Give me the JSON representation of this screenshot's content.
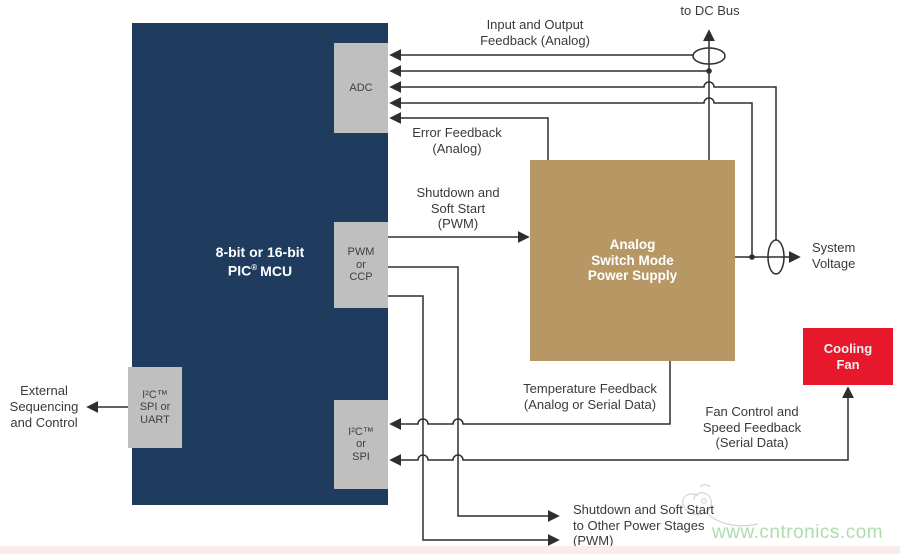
{
  "blocks": {
    "mcu": {
      "line1": "8-bit or 16-bit",
      "line2_pre": "PIC",
      "line2_sup": "®",
      "line2_post": "MCU"
    },
    "adc": {
      "label": "ADC"
    },
    "pwm": {
      "line1": "PWM",
      "line2": "or",
      "line3": "CCP"
    },
    "i2c_spi": {
      "line1": "I²C™",
      "line2": "or",
      "line3": "SPI"
    },
    "i2c_spi_uart": {
      "line1": "I²C™",
      "line2": "SPI or",
      "line3": "UART"
    },
    "psu": {
      "line1": "Analog",
      "line2": "Switch Mode",
      "line3": "Power Supply"
    },
    "fan": {
      "line1": "Cooling",
      "line2": "Fan"
    }
  },
  "labels": {
    "to_dc_bus": "to DC Bus",
    "input_output": {
      "line1": "Input and Output",
      "line2": "Feedback (Analog)"
    },
    "error_feedback": {
      "line1": "Error Feedback",
      "line2": "(Analog)"
    },
    "shutdown_soft_start": {
      "line1": "Shutdown and",
      "line2": "Soft Start",
      "line3": "(PWM)"
    },
    "system_voltage": {
      "line1": "System",
      "line2": "Voltage"
    },
    "temperature_feedback": {
      "line1": "Temperature Feedback",
      "line2": "(Analog or Serial Data)"
    },
    "fan_control": {
      "line1": "Fan Control and",
      "line2": "Speed Feedback",
      "line3": "(Serial Data)"
    },
    "shutdown_other": {
      "line1": "Shutdown and Soft Start",
      "line2": "to Other Power Stages",
      "line3": "(PWM)"
    },
    "external": {
      "line1": "External",
      "line2": "Sequencing",
      "line3": "and Control"
    },
    "watermark": "www.cntronics.com"
  },
  "colors": {
    "mcu": "#1f3b5e",
    "module": "#bfbfbf",
    "psu": "#b79864",
    "fan": "#e8182c",
    "line": "#2e2e2e",
    "watermark": "#aedcae"
  }
}
